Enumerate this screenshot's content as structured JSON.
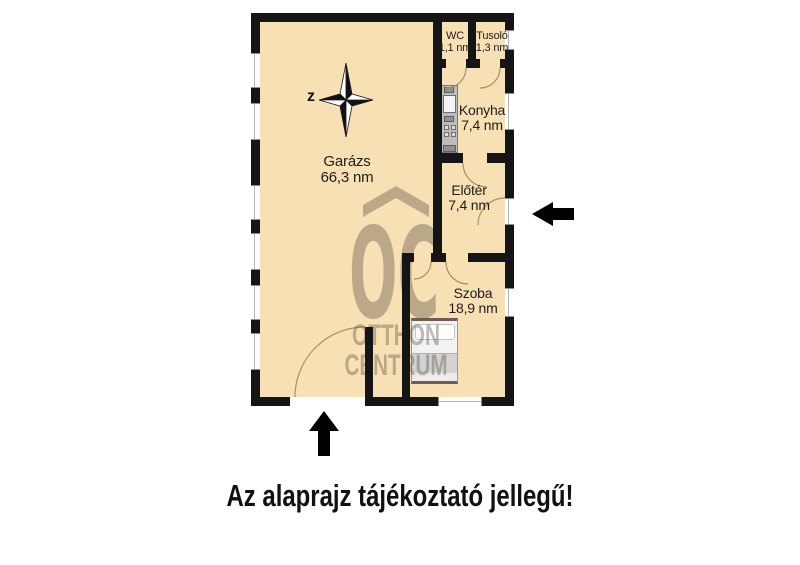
{
  "rooms": {
    "garage": {
      "name": "Garázs",
      "area": "66,3 nm"
    },
    "wc": {
      "name": "WC",
      "area": "1,1 nm"
    },
    "shower": {
      "name": "Tusoló",
      "area": "1,3 nm"
    },
    "kitchen": {
      "name": "Konyha",
      "area": "7,4 nm"
    },
    "foyer": {
      "name": "Előtér",
      "area": "7,4 nm"
    },
    "room": {
      "name": "Szoba",
      "area": "18,9 nm"
    }
  },
  "compass": {
    "north_label": "z"
  },
  "watermark": {
    "logo": "OC",
    "line1": "OTTHON",
    "line2": "CENTRUM"
  },
  "disclaimer": {
    "text": "Az alaprajz tájékoztató jellegű!"
  },
  "colors": {
    "floor": "#f7e0b4",
    "wall": "#151515",
    "watermark": "#5e5546",
    "arrow": "#000000",
    "text": "#1d1d1d"
  }
}
